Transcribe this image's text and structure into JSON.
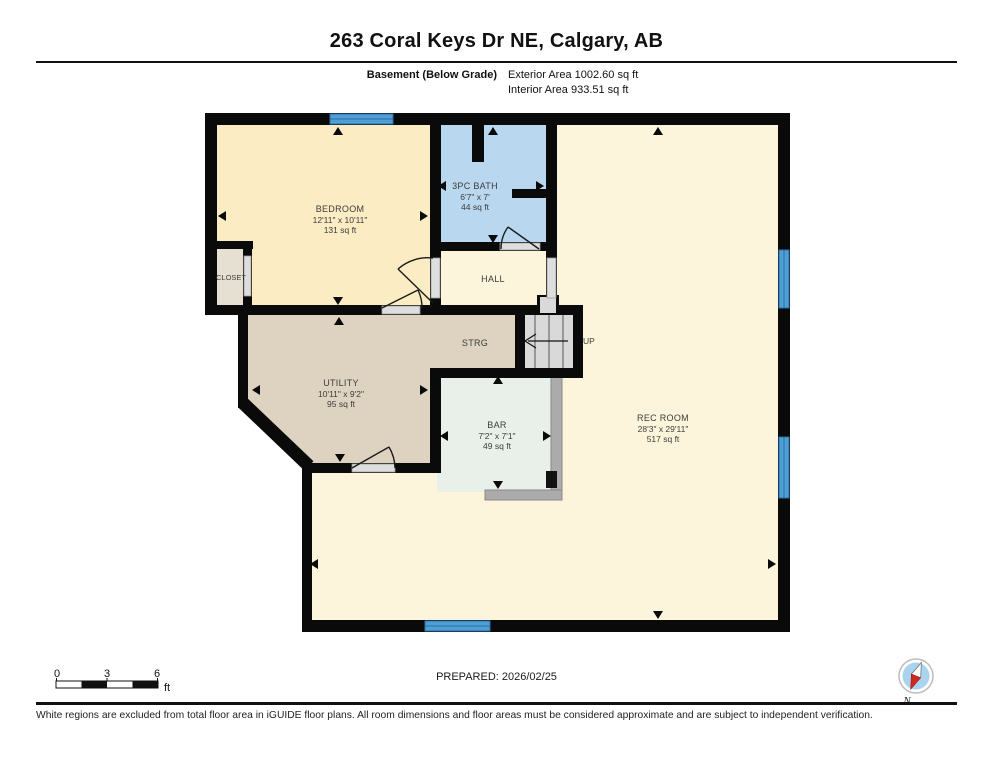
{
  "header": {
    "title": "263 Coral Keys Dr NE, Calgary, AB",
    "floor_label": "Basement (Below Grade)",
    "exterior_area": "Exterior Area 1002.60 sq ft",
    "interior_area": "Interior Area 933.51 sq ft"
  },
  "plan": {
    "rooms": {
      "bedroom": {
        "name": "BEDROOM",
        "dims": "12'11\" x 10'11\"",
        "area": "131 sq ft"
      },
      "closet": {
        "name": "CLOSET"
      },
      "bath": {
        "name": "3PC BATH",
        "dims": "6'7\" x 7'",
        "area": "44 sq ft"
      },
      "hall": {
        "name": "HALL"
      },
      "strg": {
        "name": "STRG"
      },
      "utility": {
        "name": "UTILITY",
        "dims": "10'11\" x 9'2\"",
        "area": "95 sq ft"
      },
      "bar": {
        "name": "BAR",
        "dims": "7'2\" x 7'1\"",
        "area": "49 sq ft"
      },
      "rec_room": {
        "name": "REC ROOM",
        "dims": "28'3\" x 29'11\"",
        "area": "517 sq ft"
      }
    },
    "stairs_label": "UP"
  },
  "scale_bar": {
    "tick0": "0",
    "tick3": "3",
    "tick6": "6",
    "unit": "ft"
  },
  "compass": {
    "label": "N"
  },
  "footer": {
    "prepared": "PREPARED: 2026/02/25",
    "disclaimer": "White regions are excluded from total floor area in iGUIDE floor plans. All room dimensions and floor areas must be considered approximate and are subject to independent verification."
  },
  "colors": {
    "wall": "#0a0a0a",
    "window": "#4f9fd6",
    "bedroom_fill": "#fbecc3",
    "bath_fill": "#b9d8ef",
    "utility_fill": "#ded3c0",
    "bar_fill": "#e9efe9",
    "rec_fill": "#fcf5dc",
    "closet_fill": "#e6e0d2",
    "stairs_fill": "#d9d9d9",
    "counter_fill": "#ababab",
    "compass_red": "#cc2a1e",
    "compass_blue": "#a9d3ee"
  }
}
